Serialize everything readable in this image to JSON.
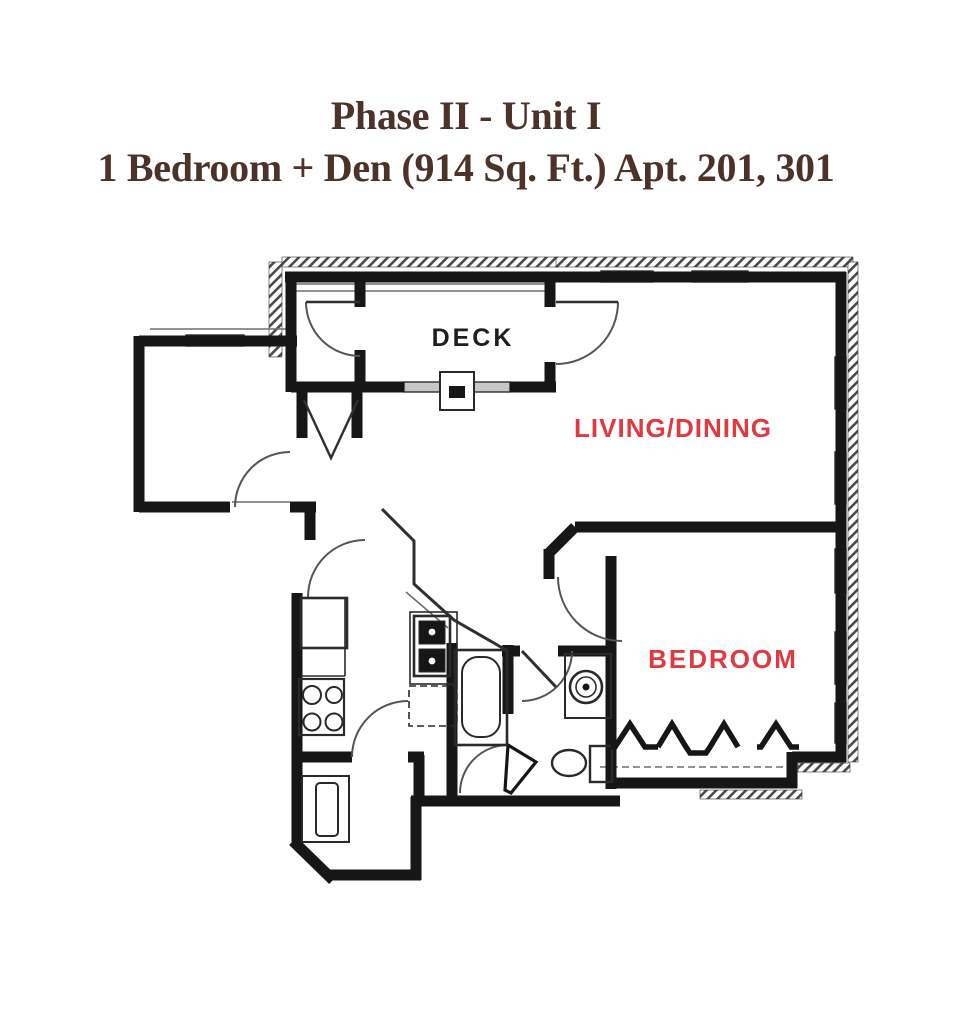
{
  "title": {
    "line1": "Phase II - Unit I",
    "line2": "1 Bedroom + Den (914 Sq. Ft.) Apt. 201, 301",
    "color": "#4b332a"
  },
  "floor_plan": {
    "rooms": [
      {
        "id": "deck",
        "label": "DECK",
        "label_color": "#1f1f1f"
      },
      {
        "id": "living-dining",
        "label": "LIVING/DINING",
        "label_color": "#df3a40"
      },
      {
        "id": "bedroom",
        "label": "BEDROOM",
        "label_color": "#df3a40"
      }
    ],
    "colors": {
      "wall": "#161616",
      "window_fill": "#c6c6c6",
      "thin_line": "#3a3a3a",
      "arc_line": "#555555",
      "accent_red": "#df3a40"
    }
  }
}
